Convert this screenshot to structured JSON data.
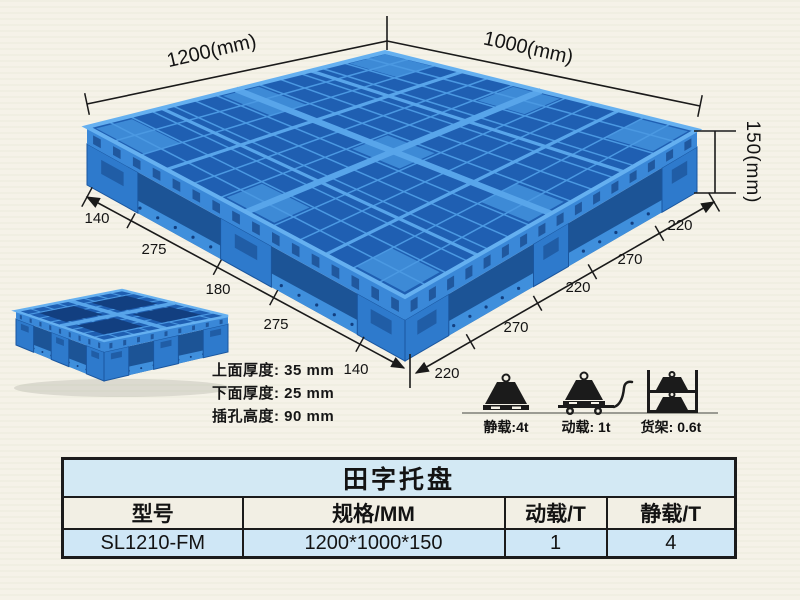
{
  "colors": {
    "pallet_blue": "#2f80d0",
    "pallet_dark_blue": "#1a55a8",
    "table_blue_bg": "#d3e9f4",
    "table_header_bg": "#f2efe4",
    "ink": "#1b1b1b"
  },
  "diagram": {
    "dim_width_label": "1200(mm)",
    "dim_depth_label": "1000(mm)",
    "dim_height_label": "150(mm)",
    "edge_left_segments": [
      "140",
      "275",
      "180",
      "275",
      "140"
    ],
    "edge_right_segments": [
      "220",
      "270",
      "220",
      "270",
      "220"
    ],
    "specs": [
      "上面厚度: 35 mm",
      "下面厚度: 25 mm",
      "插孔高度: 90 mm"
    ]
  },
  "load_ratings": [
    {
      "icon": "static-load-icon",
      "label": "静载:4t"
    },
    {
      "icon": "dynamic-load-icon",
      "label": "动载: 1t"
    },
    {
      "icon": "rack-load-icon",
      "label": "货架: 0.6t"
    }
  ],
  "table": {
    "title": "田字托盘",
    "headers": [
      "型号",
      "规格/MM",
      "动载/T",
      "静载/T"
    ],
    "rows": [
      [
        "SL1210-FM",
        "1200*1000*150",
        "1",
        "4"
      ]
    ]
  }
}
